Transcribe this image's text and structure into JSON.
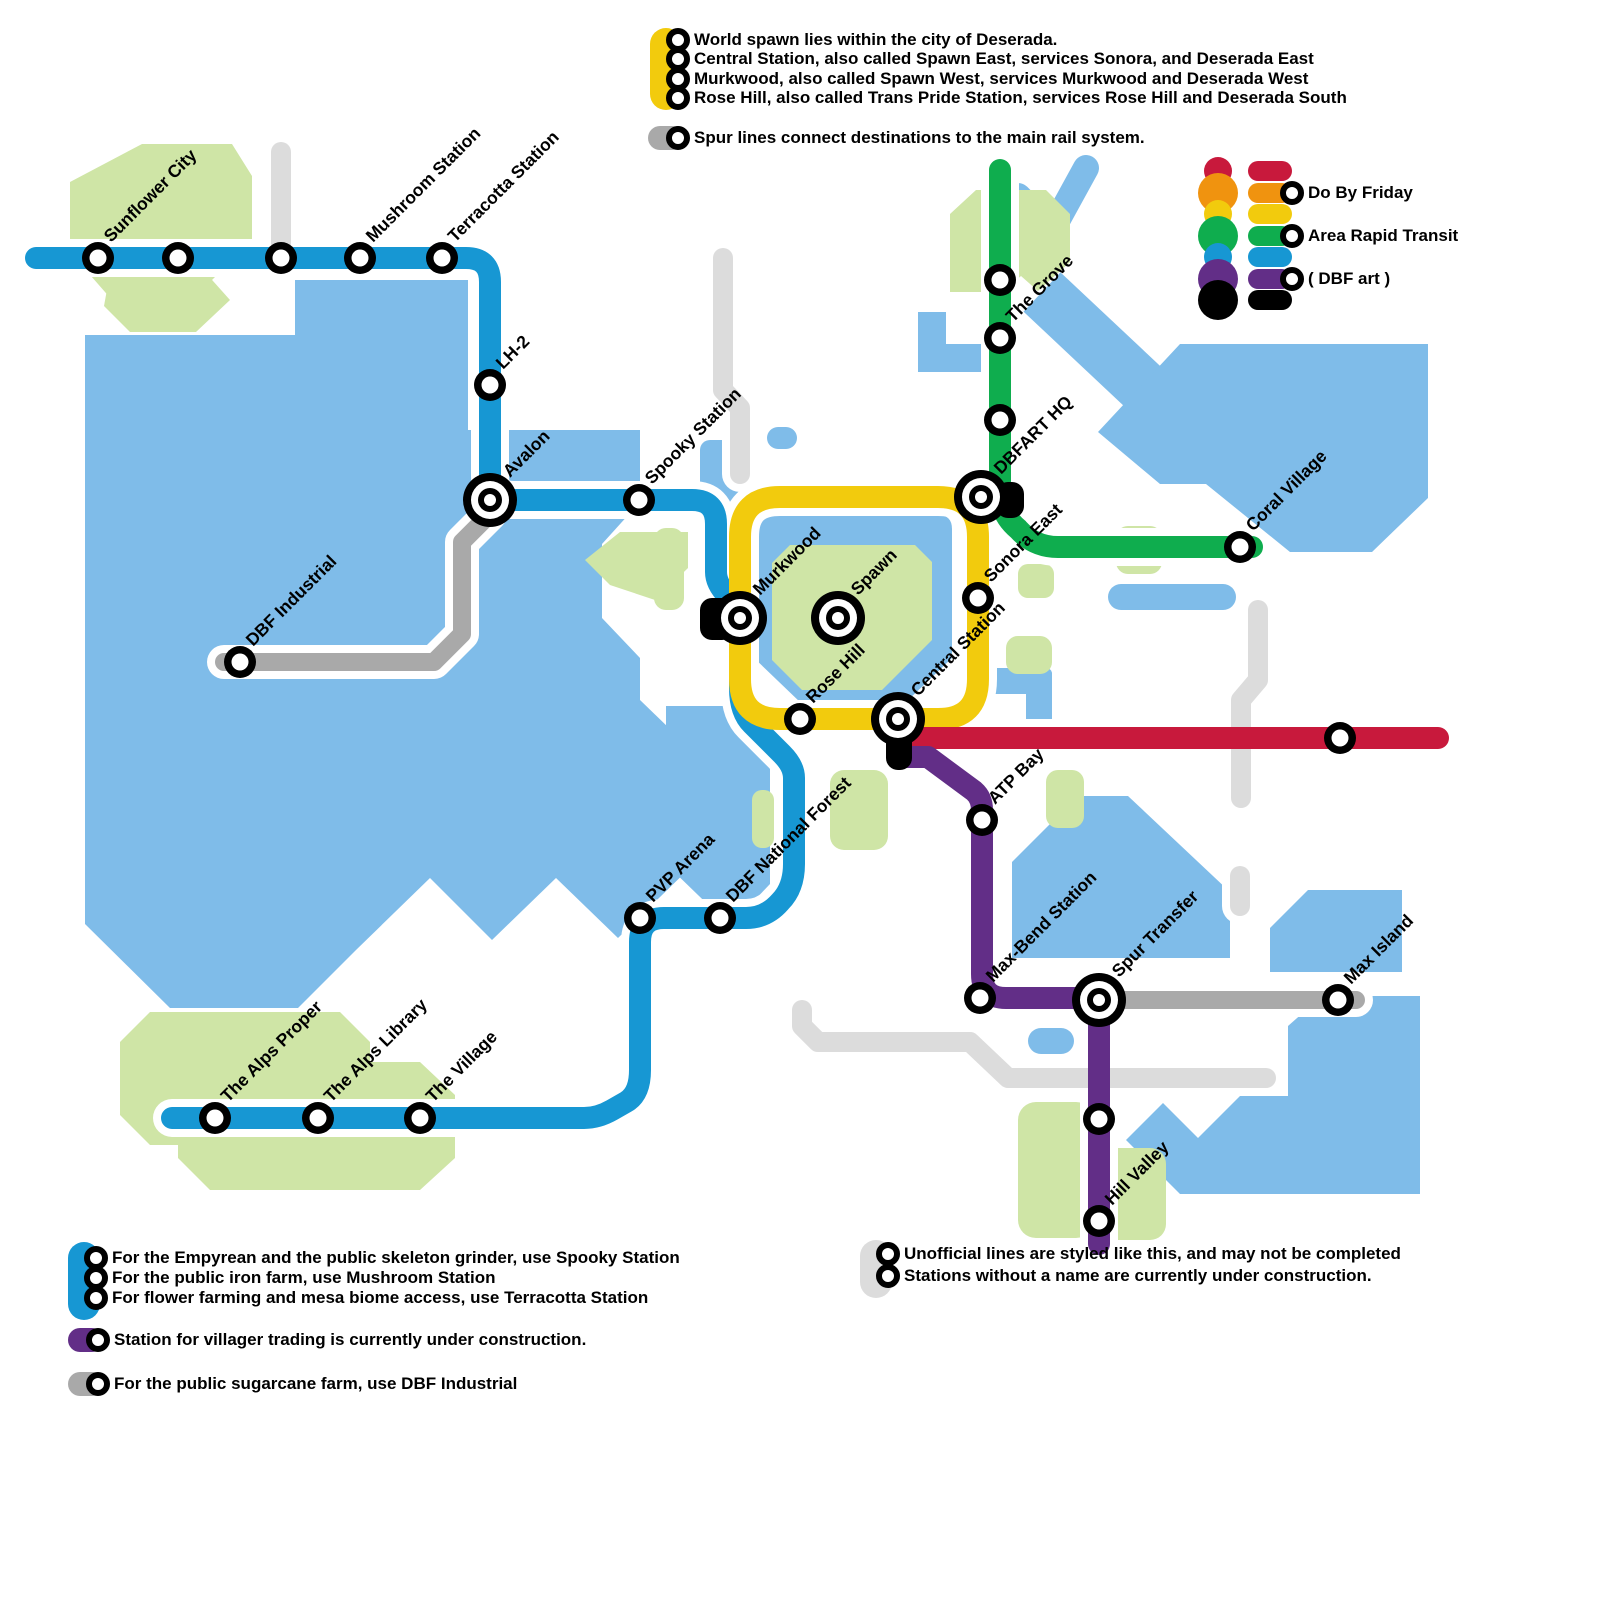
{
  "map_title": "Deserada rail network map",
  "notes_top": {
    "spawn": [
      "World spawn lies within the city of Deserada.",
      "Central Station, also called Spawn East, services Sonora, and Deserada East",
      "Murkwood, also called Spawn West, services Murkwood and Deserada West",
      "Rose Hill, also called Trans Pride Station, services Rose Hill and Deserada South"
    ],
    "spur": "Spur lines connect destinations to the main rail system."
  },
  "legend": {
    "flag": [
      {
        "color": "#C8193C",
        "label": ""
      },
      {
        "color": "#F0930F",
        "label": "Do By Friday"
      },
      {
        "color": "#F2CB0D",
        "label": ""
      },
      {
        "color": "#0FAD4E",
        "label": "Area Rapid Transit"
      },
      {
        "color": "#1797D3",
        "label": ""
      },
      {
        "color": "#622E87",
        "label": "( DBF art )"
      },
      {
        "color": "#000000",
        "label": ""
      }
    ]
  },
  "notes_bottom_left": {
    "blue": [
      "For the Empyrean and the public skeleton grinder, use Spooky Station",
      "For the public iron farm, use Mushroom Station",
      "For flower farming and mesa biome access, use Terracotta Station"
    ],
    "purple": "Station for villager trading is currently under construction.",
    "gray": "For the public sugarcane farm, use DBF Industrial"
  },
  "notes_bottom_right": [
    "Unofficial lines are styled like this, and may not be completed",
    "Stations without a name are currently under construction."
  ],
  "colors": {
    "blue_line": "#1797D3",
    "yellow_line": "#F2CB0D",
    "green_line": "#0FAD4E",
    "red_line": "#C8193C",
    "purple_line": "#622E87",
    "spur_gray": "#A9A9A9",
    "unofficial_gray": "#DCDCDC",
    "land_blue": "#7FBCE9",
    "land_green": "#CFE5A6",
    "black": "#000000"
  },
  "map": {
    "lines": [
      {
        "name": "unofficial-stub-nw",
        "color": "#DCDCDC",
        "width": 20,
        "d": "M 281 152 V 250"
      },
      {
        "name": "unofficial-center",
        "color": "#DCDCDC",
        "width": 20,
        "d": "M 723 258 V 390 L 740 408 V 474"
      },
      {
        "name": "unofficial-coral",
        "color": "#DCDCDC",
        "width": 20,
        "d": "M 1258 610 V 680 L 1241 700 V 798"
      },
      {
        "name": "unofficial-south",
        "color": "#DCDCDC",
        "width": 20,
        "d": "M 802 1010 V 1026 L 818 1042 H 970 L 1008 1078 H 1266"
      },
      {
        "name": "unofficial-stub-se",
        "color": "#DCDCDC",
        "width": 20,
        "d": "M 1240 876 V 906"
      },
      {
        "name": "spur-dbf-industrial",
        "color": "#A9A9A9",
        "width": 18,
        "d": "M 490 506 V 514 L 462 542 V 634 L 434 662 H 224"
      },
      {
        "name": "spur-max-island",
        "color": "#A9A9A9",
        "width": 18,
        "d": "M 1099 1000 H 1356"
      },
      {
        "name": "line-blue-main",
        "color": "#1797D3",
        "width": 22,
        "d": "M 36 258 H 466 Q 490 258 490 282 V 476 Q 490 500 514 500 H 692 Q 716 500 716 524 V 572 Q 716 584 728 596 Q 740 608 740 620 V 688 Q 740 712 752 724 L 782 754 Q 794 766 794 778 V 864 Q 794 888 780 902 Q 766 918 746 918 H 664 Q 640 918 640 942 V 1070 Q 640 1094 626 1102 L 612 1110 Q 598 1118 584 1118 H 172"
      },
      {
        "name": "line-yellow-loop",
        "color": "#F2CB0D",
        "width": 22,
        "d": "M 780 497 H 938 Q 978 497 978 537 V 679 Q 978 719 938 719 H 780 Q 740 719 740 679 V 537 Q 740 497 780 497 Z"
      },
      {
        "name": "line-green",
        "color": "#0FAD4E",
        "width": 22,
        "d": "M 1000 170 V 490 Q 1000 514 1018 529 Q 1034 547 1058 547 H 1252"
      },
      {
        "name": "line-red",
        "color": "#C8193C",
        "width": 22,
        "d": "M 902 738 H 1438"
      },
      {
        "name": "line-purple",
        "color": "#622E87",
        "width": 22,
        "d": "M 902 757 H 928 L 974 791 Q 982 798 982 810 V 974 Q 982 998 1006 998 H 1077 Q 1099 998 1099 1020 V 1244"
      }
    ],
    "black_marks": [
      {
        "name": "dbf-art-murkwood",
        "x": 700,
        "y": 598,
        "w": 34,
        "h": 42
      },
      {
        "name": "dbf-art-dbfart-hq",
        "x": 996,
        "y": 482,
        "w": 28,
        "h": 36
      },
      {
        "name": "dbf-art-central",
        "x": 886,
        "y": 714,
        "w": 26,
        "h": 56
      }
    ],
    "stations": [
      {
        "label": "Sunflower City",
        "x": 98,
        "y": 258,
        "kind": "s"
      },
      {
        "label": "",
        "x": 178,
        "y": 258,
        "kind": "s"
      },
      {
        "label": "",
        "x": 281,
        "y": 258,
        "kind": "s"
      },
      {
        "label": "Mushroom Station",
        "x": 360,
        "y": 258,
        "kind": "s"
      },
      {
        "label": "Terracotta Station",
        "x": 442,
        "y": 258,
        "kind": "s"
      },
      {
        "label": "LH-2",
        "x": 490,
        "y": 385,
        "kind": "s"
      },
      {
        "label": "Avalon",
        "x": 490,
        "y": 500,
        "kind": "i"
      },
      {
        "label": "Spooky Station",
        "x": 639,
        "y": 500,
        "kind": "s"
      },
      {
        "label": "DBF Industrial",
        "x": 240,
        "y": 662,
        "kind": "s"
      },
      {
        "label": "Murkwood",
        "x": 740,
        "y": 618,
        "kind": "i"
      },
      {
        "label": "Spawn",
        "x": 838,
        "y": 618,
        "kind": "i"
      },
      {
        "label": "Rose Hill",
        "x": 800,
        "y": 719,
        "kind": "s"
      },
      {
        "label": "Central Station",
        "x": 898,
        "y": 719,
        "kind": "i"
      },
      {
        "label": "Sonora East",
        "x": 978,
        "y": 598,
        "kind": "s"
      },
      {
        "label": "DBFART HQ",
        "x": 981,
        "y": 497,
        "kind": "i"
      },
      {
        "label": "",
        "x": 1000,
        "y": 280,
        "kind": "s"
      },
      {
        "label": "The Grove",
        "x": 1000,
        "y": 338,
        "kind": "s"
      },
      {
        "label": "",
        "x": 1000,
        "y": 420,
        "kind": "s"
      },
      {
        "label": "Coral Village",
        "x": 1240,
        "y": 547,
        "kind": "s"
      },
      {
        "label": "",
        "x": 1340,
        "y": 738,
        "kind": "s"
      },
      {
        "label": "ATP Bay",
        "x": 982,
        "y": 820,
        "kind": "s"
      },
      {
        "label": "Max-Bend Station",
        "x": 980,
        "y": 998,
        "kind": "s"
      },
      {
        "label": "Spur Transfer",
        "x": 1099,
        "y": 1000,
        "kind": "i"
      },
      {
        "label": "Max Island",
        "x": 1338,
        "y": 1000,
        "kind": "s"
      },
      {
        "label": "",
        "x": 1099,
        "y": 1119,
        "kind": "s"
      },
      {
        "label": "Hill Valley",
        "x": 1099,
        "y": 1221,
        "kind": "s"
      },
      {
        "label": "PVP Arena",
        "x": 640,
        "y": 918,
        "kind": "s"
      },
      {
        "label": "DBF National Forest",
        "x": 720,
        "y": 918,
        "kind": "s"
      },
      {
        "label": "The Village",
        "x": 420,
        "y": 1118,
        "kind": "s"
      },
      {
        "label": "The Alps Library",
        "x": 318,
        "y": 1118,
        "kind": "s"
      },
      {
        "label": "The Alps Proper",
        "x": 215,
        "y": 1118,
        "kind": "s"
      }
    ]
  }
}
